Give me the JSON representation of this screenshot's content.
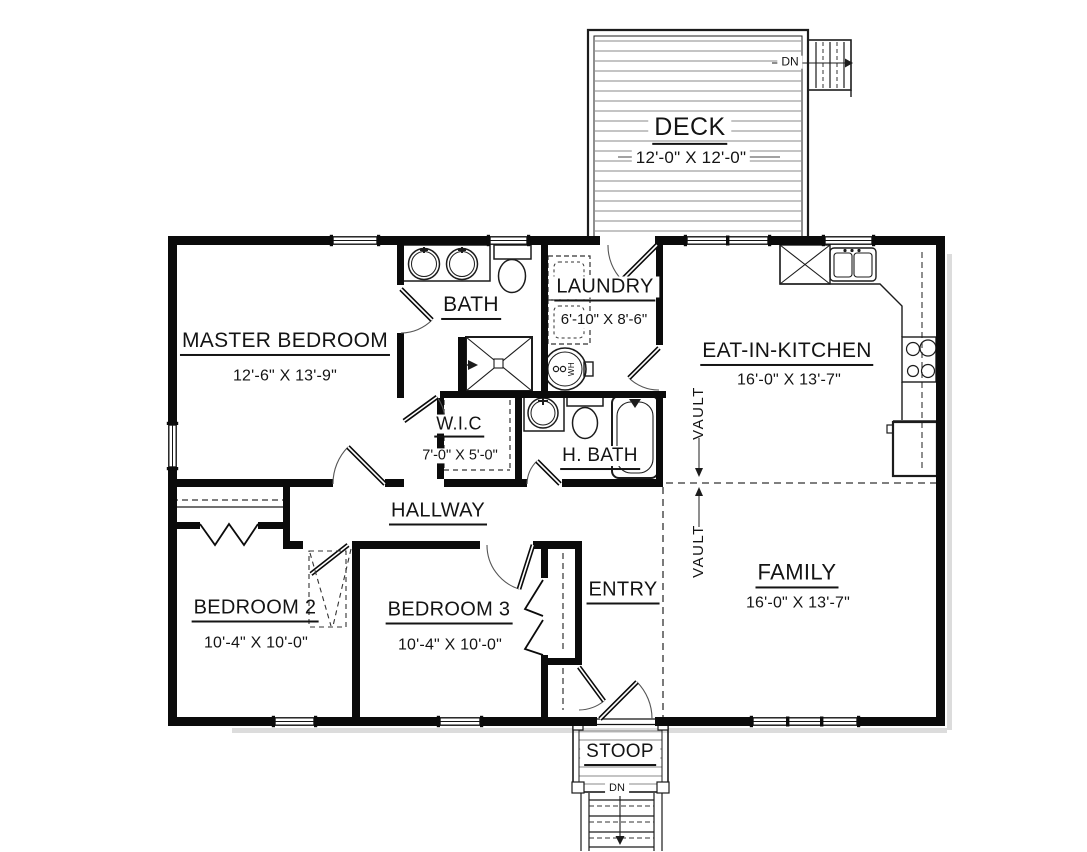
{
  "plan": {
    "deck": {
      "name": "DECK",
      "dims": "12'-0\" X 12'-0\"",
      "stairs_label": "DN"
    },
    "master_bedroom": {
      "name": "MASTER BEDROOM",
      "dims": "12'-6\" X 13'-9\""
    },
    "bath": {
      "name": "BATH"
    },
    "laundry": {
      "name": "LAUNDRY",
      "dims": "6'-10\" X 8'-6\"",
      "water_heater_label": "WH"
    },
    "eat_in_kitchen": {
      "name": "EAT-IN-KITCHEN",
      "dims": "16'-0\" X 13'-7\""
    },
    "wic": {
      "name": "W.I.C",
      "dims": "7'-0\" X 5'-0\""
    },
    "h_bath": {
      "name": "H. BATH"
    },
    "hallway": {
      "name": "HALLWAY"
    },
    "vault_label": "VAULT",
    "entry": {
      "name": "ENTRY"
    },
    "family": {
      "name": "FAMILY",
      "dims": "16'-0\" X 13'-7\""
    },
    "bedroom_2": {
      "name": "BEDROOM 2",
      "dims": "10'-4\" X 10'-0\""
    },
    "bedroom_3": {
      "name": "BEDROOM 3",
      "dims": "10'-4\" X 10'-0\""
    },
    "stoop": {
      "name": "STOOP",
      "stairs_label": "DN"
    }
  },
  "colors": {
    "wall": "#0b0b0b",
    "line": "#1c1c1c",
    "deck_board": "#8a8a8a",
    "background": "#ffffff"
  }
}
